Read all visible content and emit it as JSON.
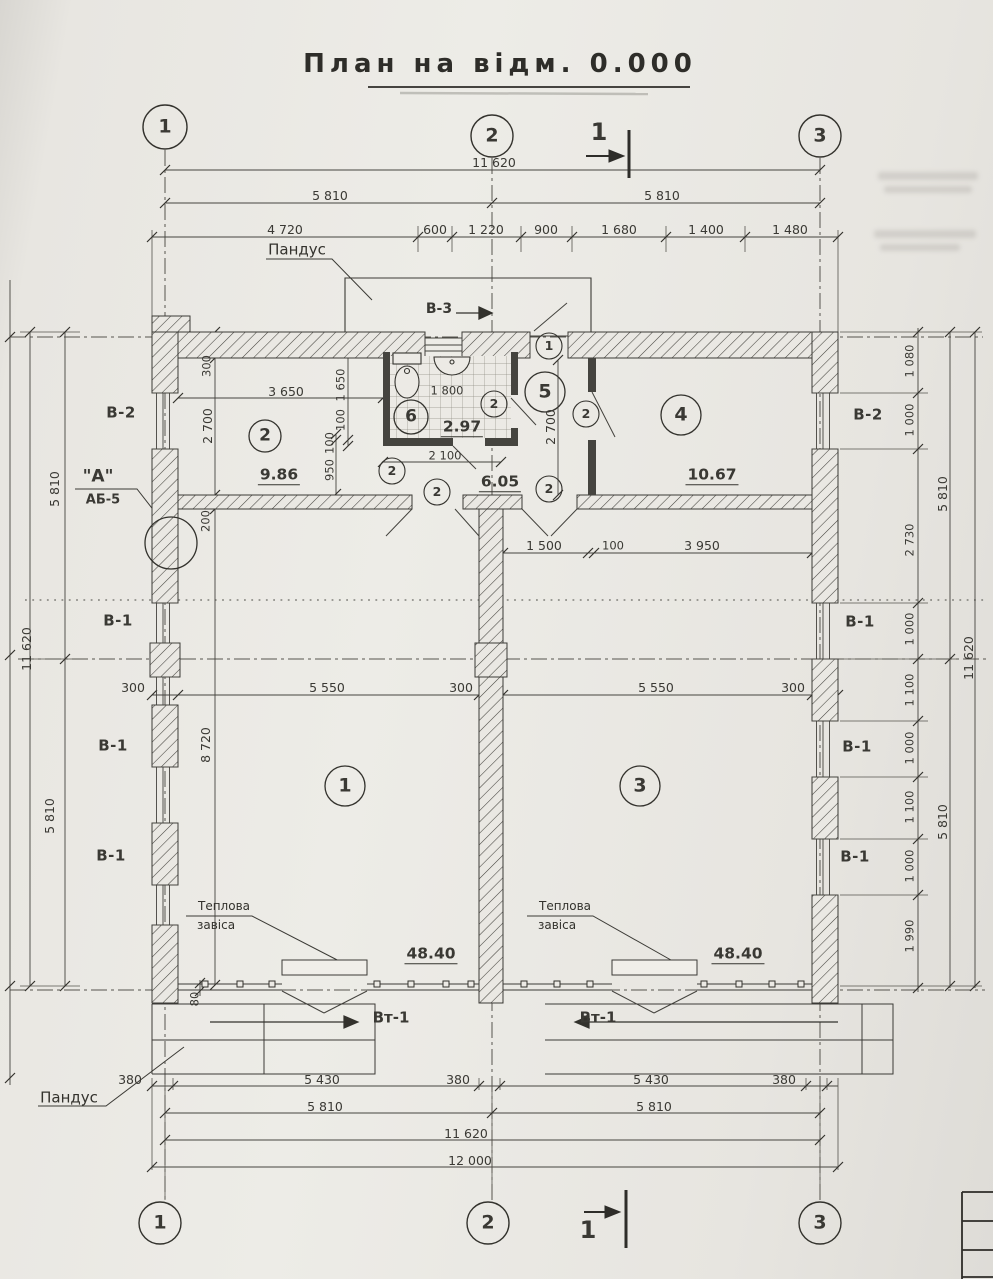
{
  "title": "План на відм. 0.000",
  "axes": {
    "a1": "1",
    "a2": "2",
    "a3": "3"
  },
  "section_mark": "1",
  "wall_types": {
    "v1": "В-1",
    "v2": "В-2",
    "v3": "В-3",
    "vt1": "Вт-1"
  },
  "annotations": {
    "ramp": "Пандус",
    "thermal1": "Теплова",
    "thermal2": "завіса",
    "detail_a": "\"А\"",
    "detail_ref": "АБ-5"
  },
  "rooms": {
    "n1": "1",
    "n2": "2",
    "n3": "3",
    "n4": "4",
    "n5": "5",
    "n6": "6",
    "area1": "48.40",
    "area2": "9.86",
    "area3": "48.40",
    "area4": "10.67",
    "area6": "2.97",
    "area_hall": "6.05"
  },
  "door_tags": {
    "t1": "1",
    "t2": "2"
  },
  "dims": {
    "d11620": "11 620",
    "d5810": "5 810",
    "d12000": "12 000",
    "top_segs": [
      "4 720",
      "600",
      "1 220",
      "900",
      "1 680",
      "1 400",
      "1 480"
    ],
    "d380": "380",
    "d5430": "5 430",
    "right_chain": [
      "1 080",
      "1 000",
      "2 730",
      "1 000",
      "1 100",
      "1 000",
      "1 100",
      "1 000",
      "1 990"
    ],
    "d300": "300",
    "d200": "200",
    "d2700": "2 700",
    "d3650": "3 650",
    "d1650": "1 650",
    "d100": "100",
    "d950": "950",
    "d1800": "1 800",
    "d2100": "2 100",
    "d1500": "1 500",
    "d3950": "3 950",
    "d5550": "5 550",
    "d8720": "8 720",
    "d80": "80"
  }
}
